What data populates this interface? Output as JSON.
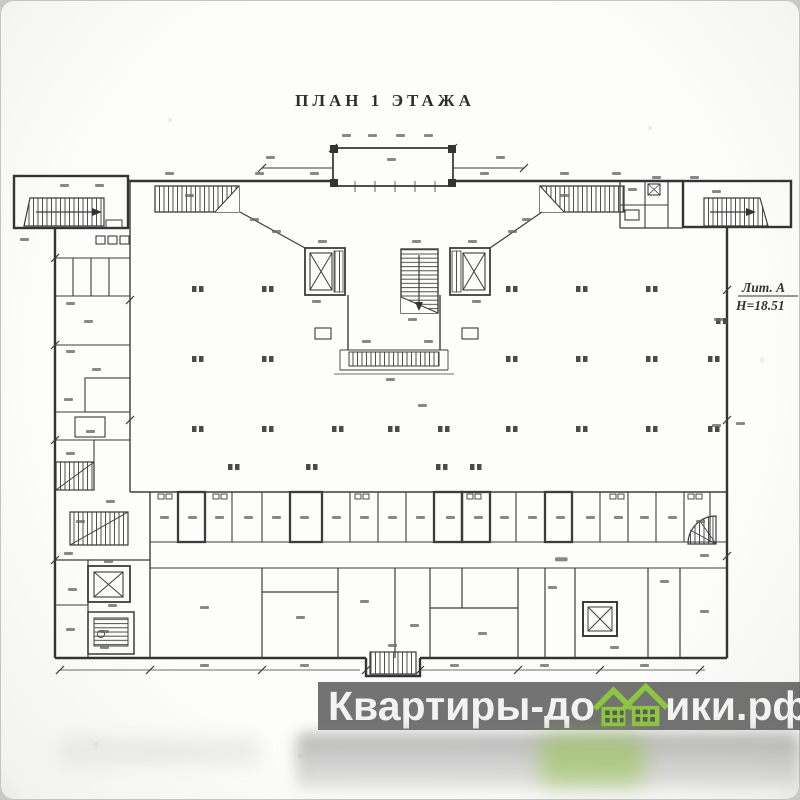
{
  "photo": {
    "corner_background": "#c9c9c9",
    "paper_color": "#fcfcfb"
  },
  "plan": {
    "title": "ПЛАН 1 ЭТАЖА",
    "annotation": {
      "litera": "Лит. А",
      "height": "Н=18.51"
    },
    "ink_color": "#3c3c3c"
  },
  "watermark": {
    "text_before_logo": "Квартиры-до",
    "text_after_logo": "ики.рф",
    "band_color": "rgba(84,84,84,0.82)",
    "text_color": "#f3f3f3",
    "logo_green": "#8dc63f"
  }
}
